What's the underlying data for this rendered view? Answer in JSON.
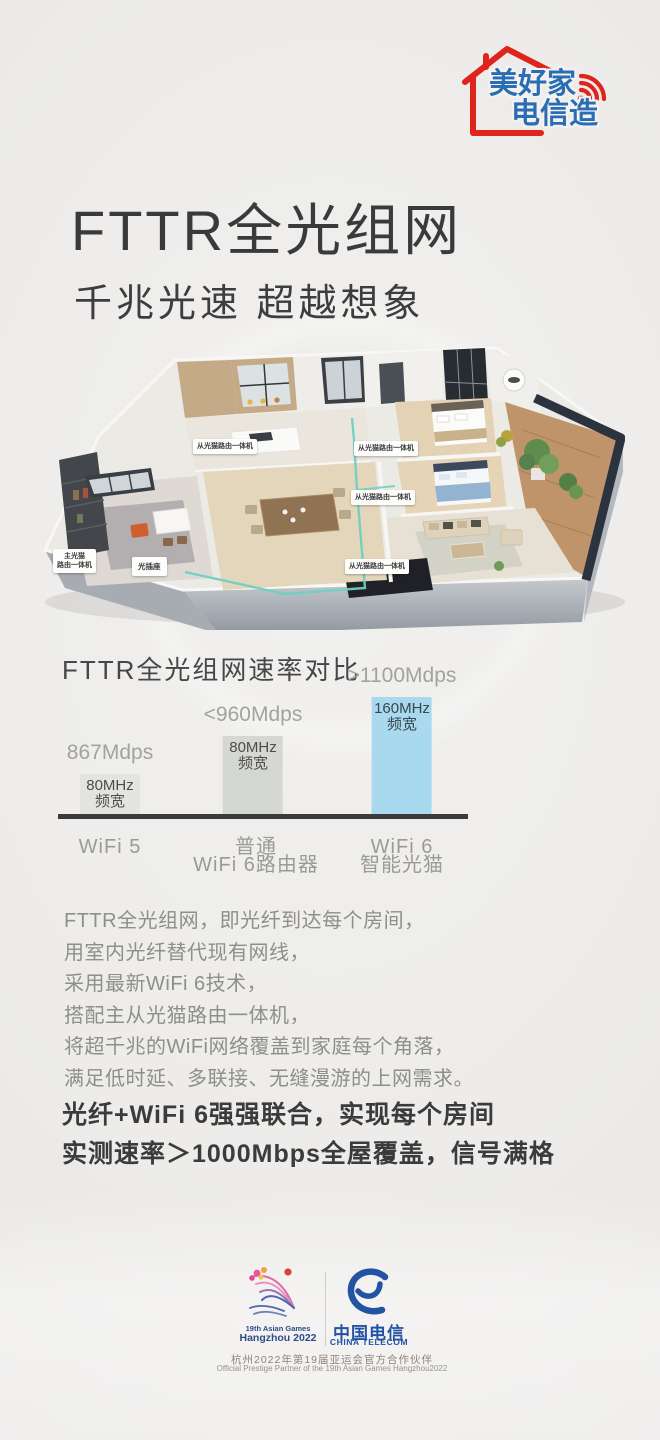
{
  "brand_logo": {
    "line1": "美好家",
    "line2": "电信造",
    "house_color": "#df241b",
    "text_color": "#2a6db5"
  },
  "hero": {
    "title": "FTTR全光组网",
    "subtitle": "千兆光速 超越想象"
  },
  "floorplan": {
    "labels": [
      {
        "text": "从光猫路由一体机"
      },
      {
        "text": "从光猫路由一体机"
      },
      {
        "text": "从光猫路由一体机"
      },
      {
        "text": "从光猫路由一体机"
      },
      {
        "text": "主光猫\n路由一体机"
      },
      {
        "text": "光插座"
      }
    ],
    "fiber_color": "#6fd0c4"
  },
  "chart_data": {
    "type": "bar",
    "title": "FTTR全光组网速率对比",
    "categories": [
      "WiFi 5",
      "普通\nWiFi 6路由器",
      "WiFi 6\n智能光猫"
    ],
    "values": [
      867,
      960,
      1100
    ],
    "value_labels": [
      "867Mdps",
      "<960Mdps",
      ">1100Mdps"
    ],
    "bar_texts": [
      "80MHz\n频宽",
      "80MHz\n频宽",
      "160MHz\n频宽"
    ],
    "colors": [
      "#e3e3e0",
      "#d5d7d4",
      "#a9d9ef"
    ],
    "bar_heights_px": [
      40,
      78,
      117
    ],
    "baseline_color": "#3b3b3b",
    "ylabel": "",
    "xlabel": ""
  },
  "body": {
    "lines": [
      "FTTR全光组网，即光纤到达每个房间，",
      "用室内光纤替代现有网线，",
      "采用最新WiFi 6技术，",
      "搭配主从光猫路由一体机，",
      "将超千兆的WiFi网络覆盖到家庭每个角落，",
      "满足低时延、多联接、无缝漫游的上网需求。"
    ]
  },
  "highlight": {
    "line1": "光纤+WiFi 6强强联合，实现每个房间",
    "line2": "实测速率＞1000Mbps全屋覆盖，信号满格"
  },
  "footer": {
    "asian_games": {
      "line1": "19th Asian Games",
      "line2": "Hangzhou 2022"
    },
    "telecom": {
      "name_cn": "中国电信",
      "name_en": "CHINA TELECOM",
      "logo_color": "#2353a3"
    },
    "partner_cn": "杭州2022年第19届亚运会官方合作伙伴",
    "partner_en": "Official Prestige Partner of the 19th Asian Games Hangzhou2022"
  }
}
